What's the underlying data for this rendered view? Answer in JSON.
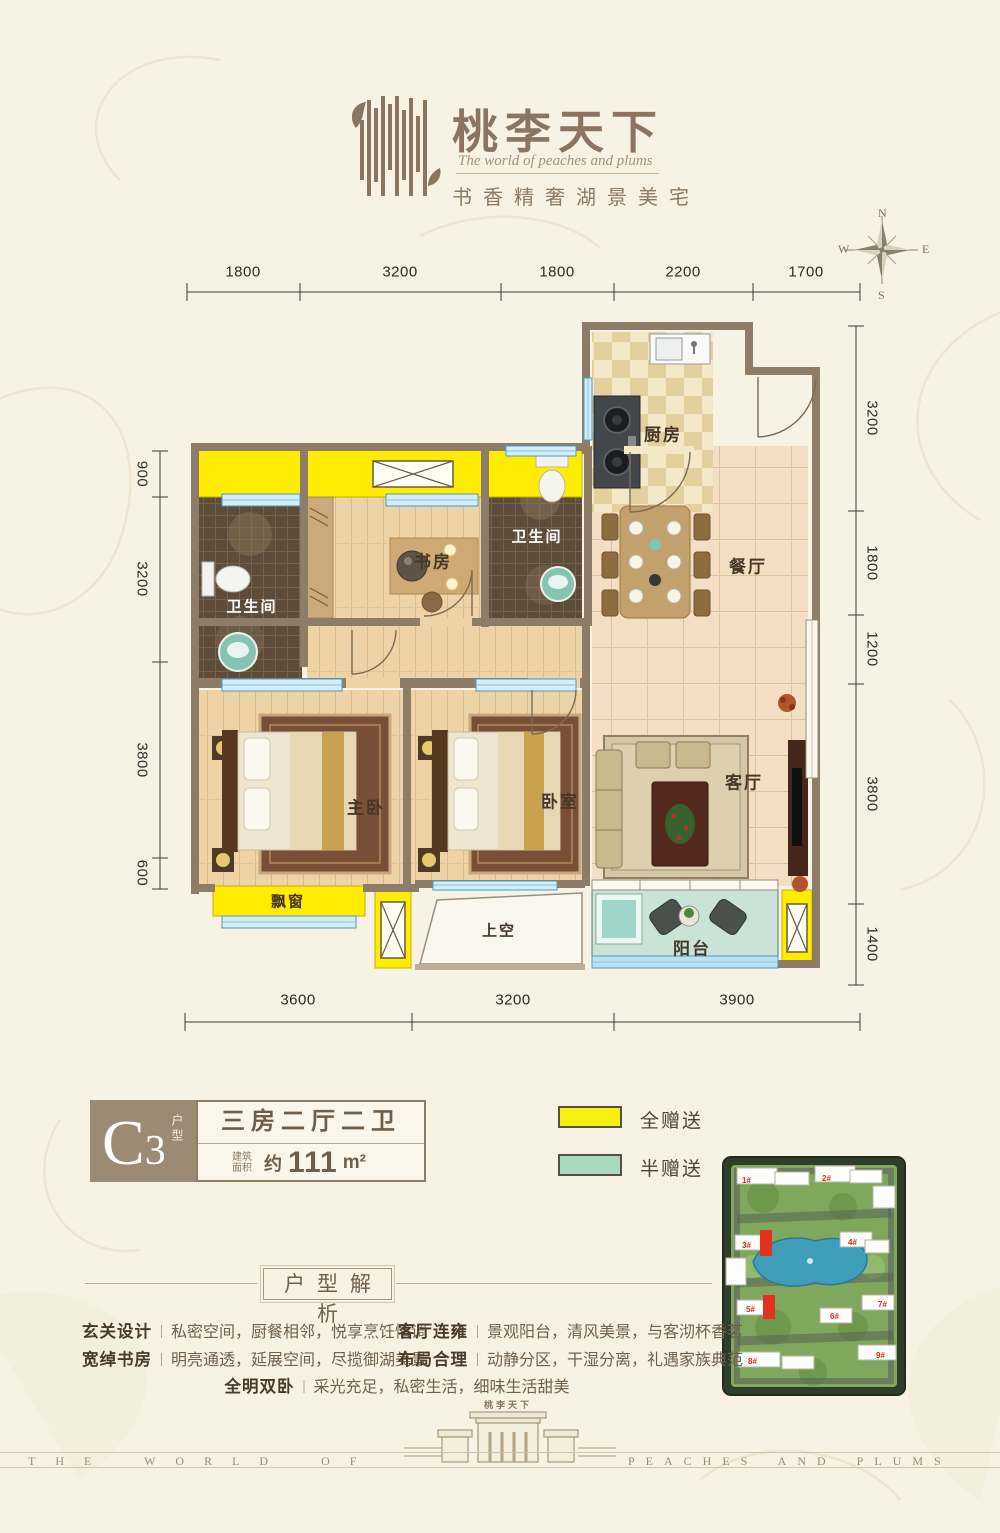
{
  "header": {
    "title": "桃李天下",
    "subtitle": "The world of peaches and plums",
    "tagline": "书香精奢湖景美宅"
  },
  "compass": {
    "north": "N",
    "south": "S",
    "east": "E",
    "west": "W"
  },
  "floorplan": {
    "rooms": {
      "kitchen": "厨房",
      "bath_second": "卫生间",
      "study": "书房",
      "dining": "餐厅",
      "bath_main": "卫生间",
      "living": "客厅",
      "master_bedroom": "主卧",
      "bedroom": "卧室",
      "bay_window": "飘窗",
      "void_above": "上空",
      "balcony": "阳台"
    },
    "dims_top": [
      "1800",
      "3200",
      "1800",
      "2200",
      "1700"
    ],
    "dims_left": [
      "900",
      "3200",
      "3800",
      "600"
    ],
    "dims_right": [
      "3200",
      "1800",
      "1200",
      "3800",
      "1400"
    ],
    "dims_bottom": [
      "3600",
      "3200",
      "3900"
    ]
  },
  "unit": {
    "code": "C3",
    "code_label": "户型",
    "layout": "三房二厅二卫",
    "area_label": "建筑面积",
    "area_approx": "约",
    "area_value": "111",
    "area_unit": "m²"
  },
  "legend": [
    {
      "label": "全赠送",
      "color": "#f7ee12"
    },
    {
      "label": "半赠送",
      "color": "#a9d9bd"
    }
  ],
  "siteplan": {
    "buildings": [
      "1#",
      "2#",
      "3#",
      "4#",
      "5#",
      "6#",
      "7#",
      "8#",
      "9#"
    ]
  },
  "analysis": {
    "title": "户型解析",
    "items": [
      {
        "label": "玄关设计",
        "text": "私密空间，厨餐相邻，悦享烹饪情调"
      },
      {
        "label": "宽绰书房",
        "text": "明亮通透，延展空间，尽揽御湖美景"
      },
      {
        "label": "客厅连雍",
        "text": "景观阳台，清风美景，与客沏杯香茗"
      },
      {
        "label": "布局合理",
        "text": "动静分区，干湿分离，礼遇家族典范"
      },
      {
        "label": "全明双卧",
        "text": "采光充足，私密生活，细味生活甜美"
      }
    ]
  },
  "footer": {
    "left": "THE WORLD OF",
    "right": "PEACHES AND PLUMS",
    "gate_title": "桃李天下"
  }
}
